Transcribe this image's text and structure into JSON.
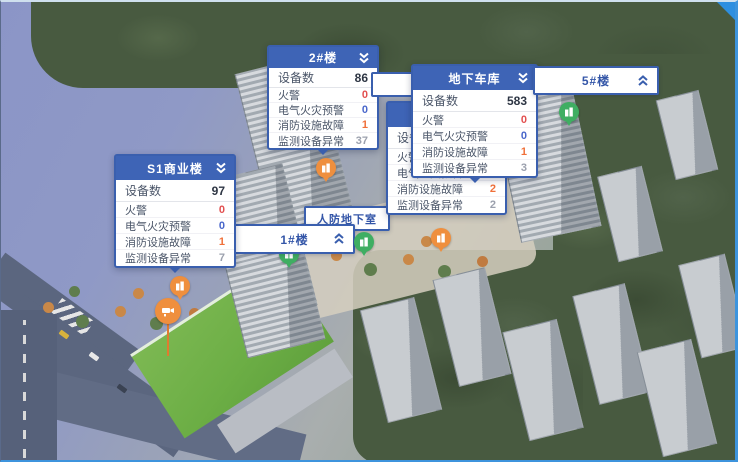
{
  "colors": {
    "panel_accent": "#3e64b6",
    "panel_border": "#3a5fae",
    "device_value": "#2e3644",
    "fire_value": "#e25050",
    "electric_value": "#4a67cb",
    "fault_value": "#f0703a",
    "monitor_value": "#9ba0ad",
    "marker_orange": "#ef8f3e",
    "marker_green": "#3fae62"
  },
  "panels": {
    "b2": {
      "title": "2#楼",
      "device": {
        "label": "设备数",
        "value": "86"
      },
      "rows": [
        {
          "label": "火警",
          "value": "0"
        },
        {
          "label": "电气火灾预警",
          "value": "0"
        },
        {
          "label": "消防设施故障",
          "value": "1"
        },
        {
          "label": "监测设备异常",
          "value": "37"
        }
      ]
    },
    "garage": {
      "title": "地下车库",
      "device": {
        "label": "设备数",
        "value": "583"
      },
      "rows": [
        {
          "label": "火警",
          "value": "0"
        },
        {
          "label": "电气火灾预警",
          "value": "0"
        },
        {
          "label": "消防设施故障",
          "value": "1"
        },
        {
          "label": "监测设备异常",
          "value": "3"
        }
      ]
    },
    "s1": {
      "title": "S1商业楼",
      "device": {
        "label": "设备数",
        "value": "97"
      },
      "rows": [
        {
          "label": "火警",
          "value": "0"
        },
        {
          "label": "电气火灾预警",
          "value": "0"
        },
        {
          "label": "消防设施故障",
          "value": "1"
        },
        {
          "label": "监测设备异常",
          "value": "7"
        }
      ]
    },
    "hidden": {
      "title": "",
      "device": {
        "label": "设备数",
        "value": ""
      },
      "rows": [
        {
          "label": "火警",
          "value": ""
        },
        {
          "label": "电气火灾预警",
          "value": ""
        },
        {
          "label": "消防设施故障",
          "value": "2"
        },
        {
          "label": "监测设备异常",
          "value": "2"
        }
      ]
    }
  },
  "bars": {
    "b1": {
      "label": "1#楼"
    },
    "b5": {
      "label": "5#楼"
    },
    "renfang": {
      "label": "人防地下室"
    }
  }
}
